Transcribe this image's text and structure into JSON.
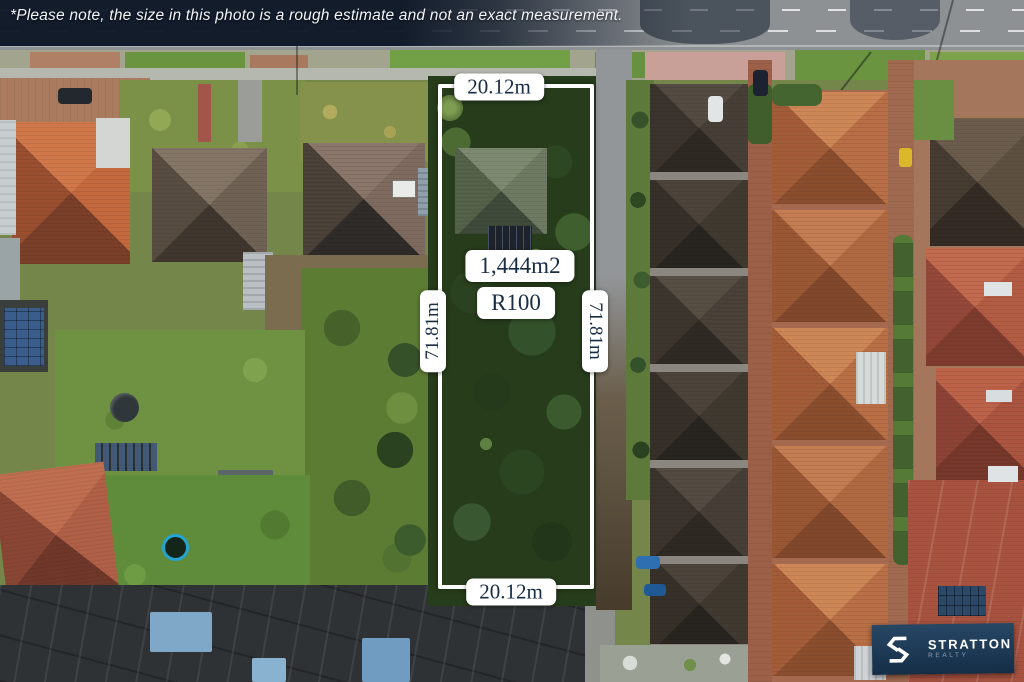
{
  "disclaimer": {
    "text": "*Please note, the size in this photo is a rough estimate and not an exact measurement."
  },
  "measurements": {
    "frontage_top": "20.12m",
    "frontage_bottom": "20.12m",
    "depth_left": "71.81m",
    "depth_right": "71.81m",
    "area": "1,444m2",
    "zoning": "R100"
  },
  "branding": {
    "name": "STRATTON",
    "tagline": "REALTY"
  },
  "colors": {
    "lot_outline": "#ffffff",
    "label_background": "#ffffff",
    "label_text": "#182c44",
    "brand_background": "#1d3a57",
    "brand_text": "#ffffff",
    "brand_tagline_text": "#8ba0b4"
  }
}
